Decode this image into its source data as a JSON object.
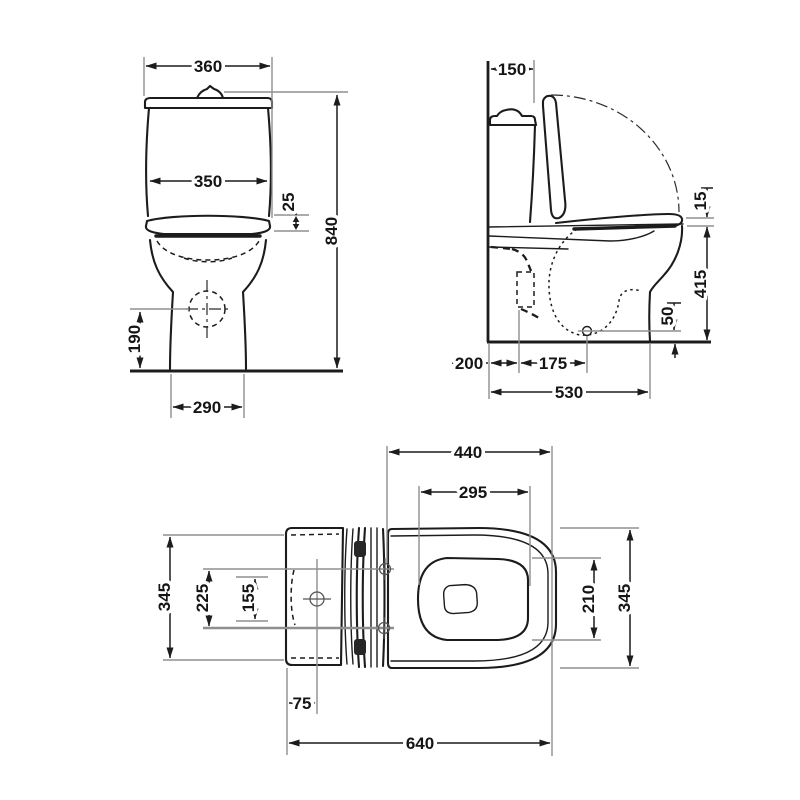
{
  "drawing": {
    "subject": "Close-coupled WC toilet with cistern and seat — dimensioned technical drawing, three orthographic views",
    "views": [
      "front view",
      "side view",
      "plan view"
    ],
    "units": "mm",
    "colors": {
      "object_line": "#1c1c1c",
      "extension_line": "#8f8f8f",
      "text": "#151515",
      "background": "#ffffff"
    }
  },
  "front_view": {
    "name": "front-view",
    "dims": {
      "cistern_lid_width": "360",
      "cistern_width": "350",
      "seat_edge_thickness": "25",
      "overall_height": "840",
      "outlet_centre_height": "190",
      "foot_width": "290"
    }
  },
  "side_view": {
    "name": "side-view",
    "dims": {
      "cistern_depth": "150",
      "seat_thickness": "15",
      "rim_height": "415",
      "outlet_above_floor": "50",
      "wall_to_fixing": "200",
      "fixing_to_outlet": "175",
      "wall_to_front": "530"
    }
  },
  "plan_view": {
    "name": "plan-view",
    "dims": {
      "hinge_to_front": "440",
      "opening_length": "295",
      "cistern_width": "345",
      "fixing_centres_outer": "225",
      "fixing_centres_inner": "155",
      "opening_width": "210",
      "overall_width": "345",
      "supply_hole_offset": "75",
      "overall_length": "640"
    }
  }
}
